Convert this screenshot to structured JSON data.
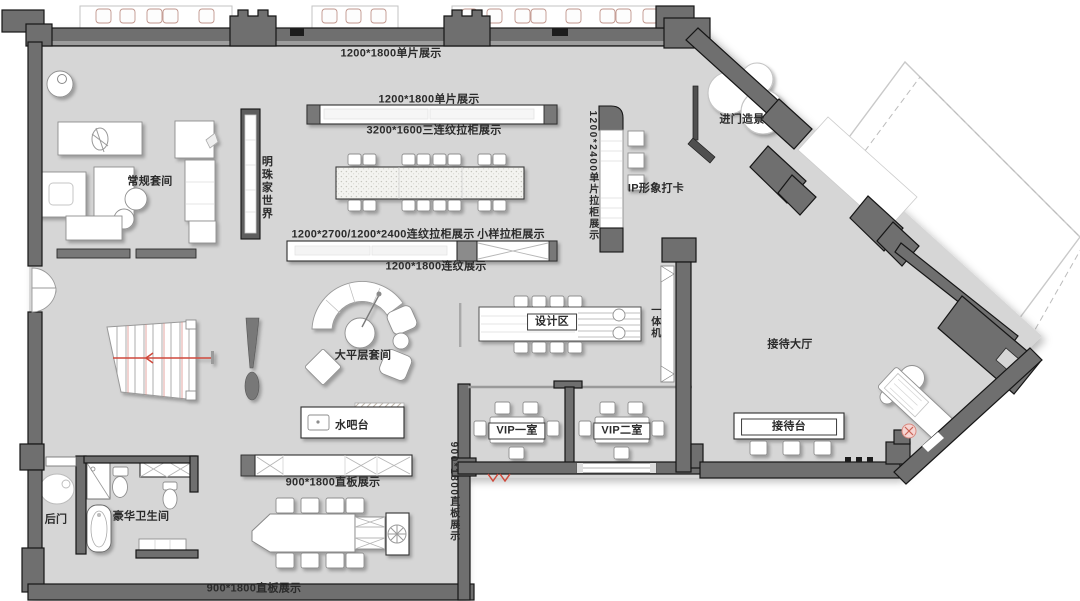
{
  "colors": {
    "floor": "#d6d6d6",
    "wall": "#6f6f6f",
    "wall_edge": "#161616",
    "glass": "#9a9a9a",
    "accent_red": "#cf4a3c",
    "label_color": "#2b2b2b"
  },
  "labels": {
    "display_top": "1200*1800单片展示",
    "display_row1_top": "1200*1800单片展示",
    "display_row1_bottom": "3200*1600三连纹拉柜展示",
    "regular_suite": "常规套间",
    "pearl_world": "明珠家世界",
    "display_row2_top": "1200*2700/1200*2400连纹拉柜展示",
    "sample_cabinet": "小样拉柜展示",
    "display_row2_bottom": "1200*1800连纹展示",
    "single_panel_cabinet": "1200*2400单片拉柜展示",
    "ip_checkin": "IP形象打卡",
    "entry_landscape": "进门造景",
    "penthouse_suite": "大平层套间",
    "design_area": "设计区",
    "all_in_one": "一体机",
    "reception_hall": "接待大厅",
    "water_bar": "水吧台",
    "vip_room_1": "VIP一室",
    "vip_room_2": "VIP二室",
    "reception_desk": "接待台",
    "straight_board_left": "900*1800直板展示",
    "straight_board_vertical": "900*1800直板展示",
    "back_door": "后门",
    "luxury_bathroom": "豪华卫生间",
    "straight_board_bottom": "900*1800直板展示"
  }
}
